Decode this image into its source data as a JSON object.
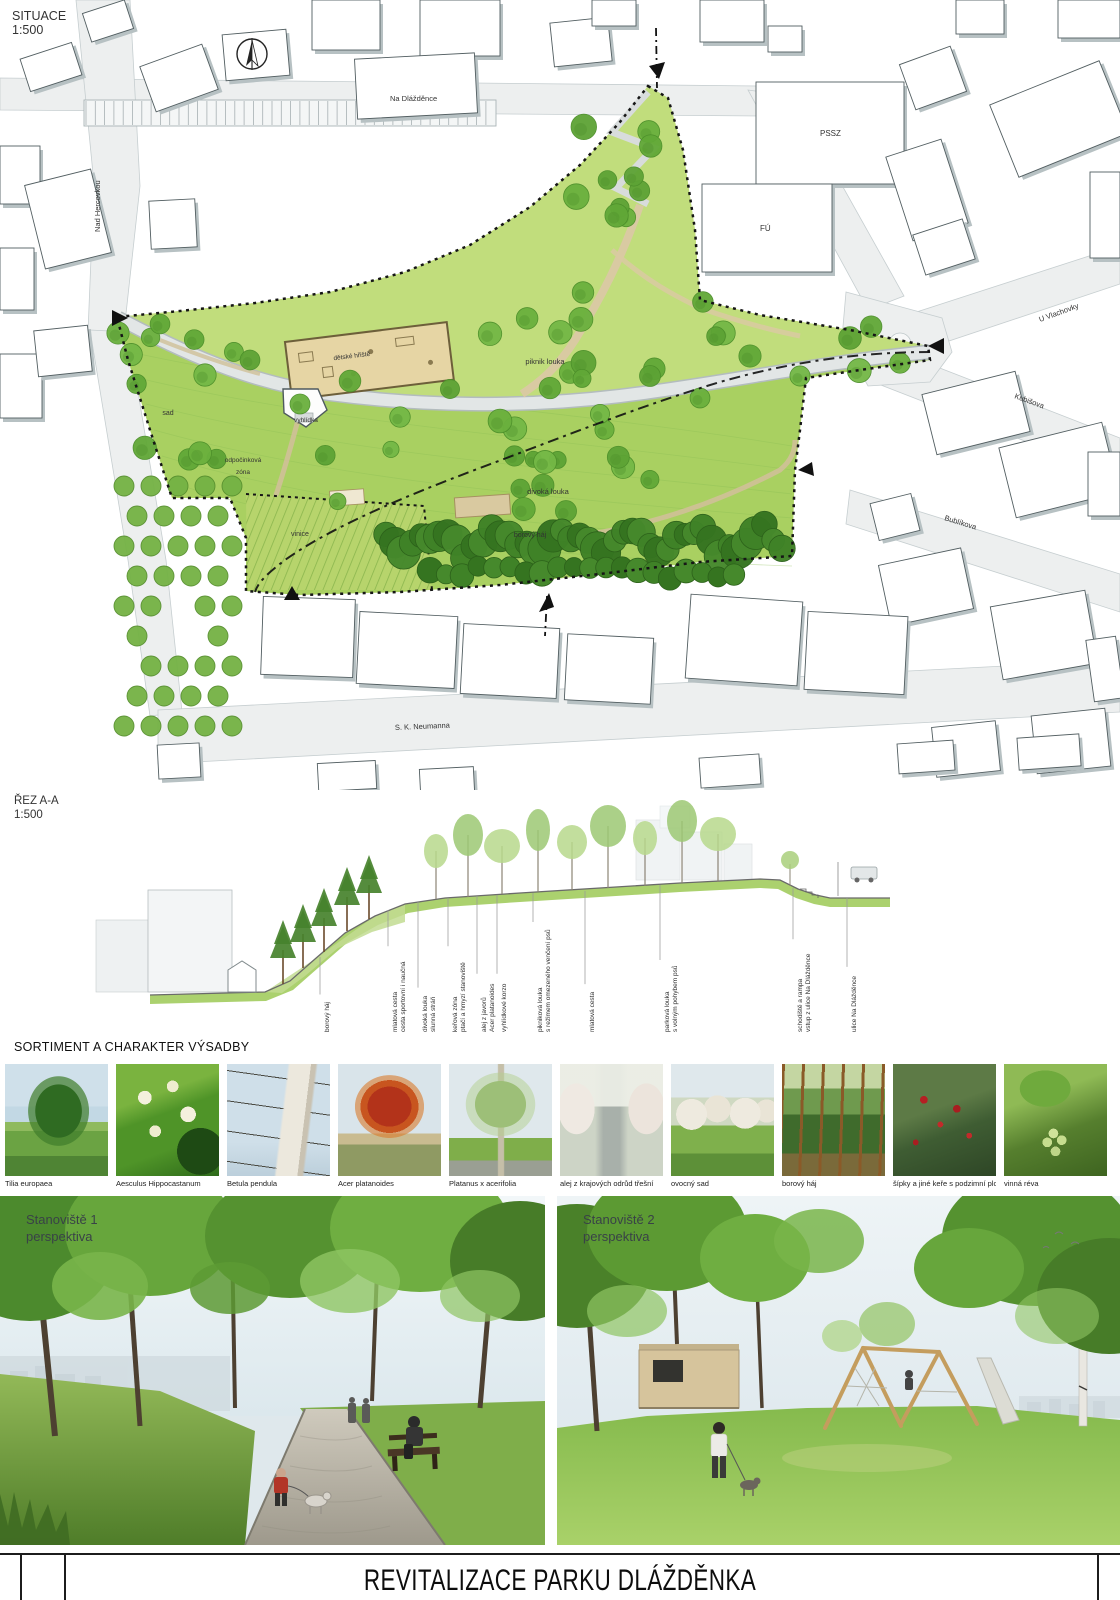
{
  "plan": {
    "label": "SITUACE",
    "scale": "1:500",
    "streets": {
      "top": "Na Dlážděnce",
      "left": "Nad Hercovkou",
      "upper_right": "U Vlachovky",
      "right": "Kubišova",
      "lower_right": "Bublíkova",
      "bottom": "S. K. Neumanna"
    },
    "buildings": {
      "pssz": "PSSZ",
      "fu": "FÚ"
    },
    "areas": {
      "playground": "dětské hřiště",
      "picnic_meadow": "piknik louka",
      "lookout": "vyhlídka",
      "orchard": "sad",
      "rest_zone_line1": "odpočinková",
      "rest_zone_line2": "zóna",
      "wild_meadow": "divoká louka",
      "vineyard": "vinice",
      "pine_grove": "borový háj"
    }
  },
  "section": {
    "label": "ŘEZ A-A",
    "scale": "1:500",
    "callouts": [
      {
        "line1": "borový háj",
        "line2": ""
      },
      {
        "line1": "mlatová cesta",
        "line2": "cesta sportovní i naučná"
      },
      {
        "line1": "divoká louka",
        "line2": "slunná stráň"
      },
      {
        "line1": "keřová zóna",
        "line2": "ptačí a hmyzí stanoviště"
      },
      {
        "line1": "alej z javorů",
        "line2": "Acer platanoides"
      },
      {
        "line1": "vyhlídkové korzo",
        "line2": ""
      },
      {
        "line1": "pikniková louka",
        "line2": "s režimem omezeného venčení psů"
      },
      {
        "line1": "mlatová cesta",
        "line2": ""
      },
      {
        "line1": "parková louka",
        "line2": "s volným pohybem psů"
      },
      {
        "line1": "schodiště a rampa",
        "line2": "vstup z ulice Na Dlážděnce"
      },
      {
        "line1": "ulice Na Dlážděnce",
        "line2": ""
      }
    ]
  },
  "sortiment": {
    "heading": "SORTIMENT A CHARAKTER VÝSADBY",
    "items": [
      {
        "label": "Tilia europaea",
        "kind": "tilia"
      },
      {
        "label": "Aesculus Hippocastanum",
        "kind": "aesculus"
      },
      {
        "label": "Betula pendula",
        "kind": "betula"
      },
      {
        "label": "Acer platanoides",
        "kind": "acer"
      },
      {
        "label": "Platanus x acerifolia",
        "kind": "platanus"
      },
      {
        "label": "alej z krajových odrůd třešní",
        "kind": "cherry"
      },
      {
        "label": "ovocný sad",
        "kind": "orchard"
      },
      {
        "label": "borový háj",
        "kind": "pine"
      },
      {
        "label": "šípky a jiné keře s podzimní plody",
        "kind": "rosehip"
      },
      {
        "label": "vinná réva",
        "kind": "vine"
      }
    ]
  },
  "perspectives": [
    {
      "title": "Stanoviště 1",
      "subtitle": "perspektiva"
    },
    {
      "title": "Stanoviště 2",
      "subtitle": "perspektiva"
    }
  ],
  "titleblock": {
    "title": "REVITALIZACE PARKU DLÁŽDĚNKA"
  },
  "colors": {
    "park_light": "#c1dd7c",
    "park_base": "#a9d061",
    "tree": "#6ab03d",
    "pine": "#3f8227",
    "path_tan": "#d9caa2",
    "street": "#edefef",
    "boundary": "#161616"
  }
}
